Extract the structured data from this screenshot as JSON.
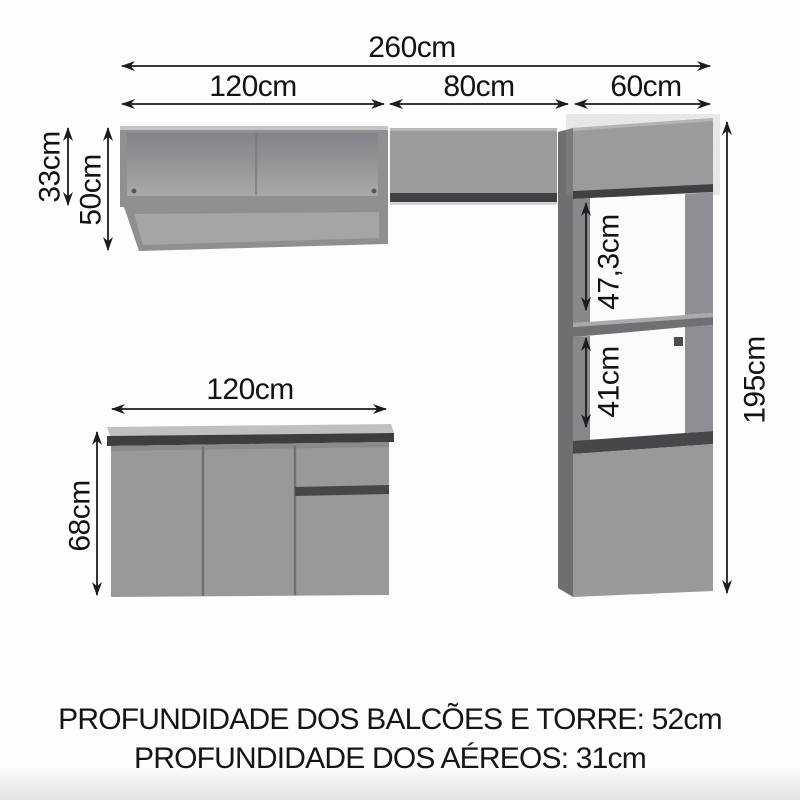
{
  "diagram": {
    "title_context": "kitchen-cabinet-dimension-diagram",
    "dims": {
      "total_width": "260cm",
      "segment_left": "120cm",
      "segment_middle": "80cm",
      "segment_right": "60cm",
      "aereo_box_height": "33cm",
      "aereo_total_height": "50cm",
      "tower_niche_upper": "47,3cm",
      "tower_niche_lower": "41cm",
      "tower_total_height": "195cm",
      "counter_width": "120cm",
      "counter_height": "68cm"
    },
    "footer": {
      "line1": "PROFUNDIDADE DOS BALCÕES E TORRE: 52cm",
      "line2": "PROFUNDIDADE DOS AÉREOS: 31cm"
    },
    "colors": {
      "cabinet_front": "#98999b",
      "cabinet_front_light": "#9b9c9e",
      "cabinet_side_panel": "#6e6f72",
      "frame_stile": "#87888c",
      "dark_edge": "#3f4043",
      "countertop_face": "#bfc0c2",
      "countertop_edge": "#3c3d3f",
      "interior_back_top": "#83848a",
      "interior_back_bottom": "#a8a9ab",
      "shelf_surface": "#a4a5a7",
      "arrow": "#1c1c1c",
      "background": "#fdfdfd",
      "floor_fade": "#e8e8e9"
    }
  }
}
